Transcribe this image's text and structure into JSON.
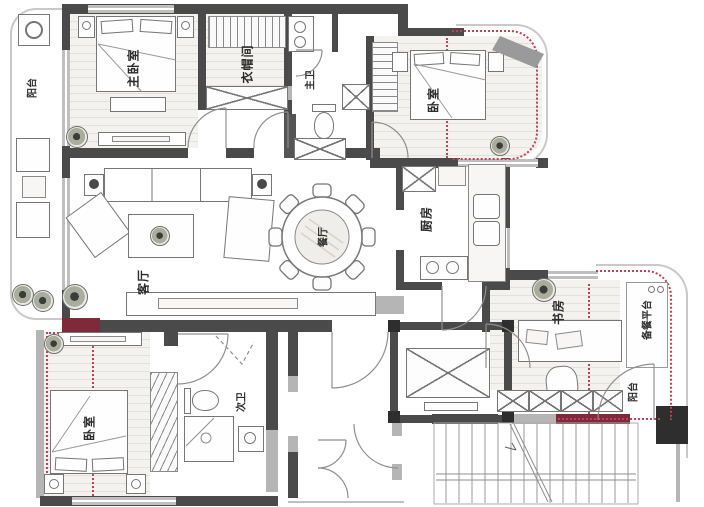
{
  "title": "apartment-floor-plan",
  "colors": {
    "wall": "#4a4a4a",
    "modification_line": "#c2415a",
    "accent_wall": "#7e2a38"
  },
  "rooms": {
    "balcony_left": "阳台",
    "master_bedroom": "主卧室",
    "cloakroom": "衣帽间",
    "master_bathroom": "主卫",
    "bedroom_upper_right": "卧室",
    "living_room": "客厅",
    "dining_room": "餐厅",
    "kitchen": "厨房",
    "study": "书房",
    "prep_platform": "备餐平台",
    "balcony_right": "阳台",
    "bedroom_lower_left": "卧室",
    "bathroom_second": "次卫"
  }
}
